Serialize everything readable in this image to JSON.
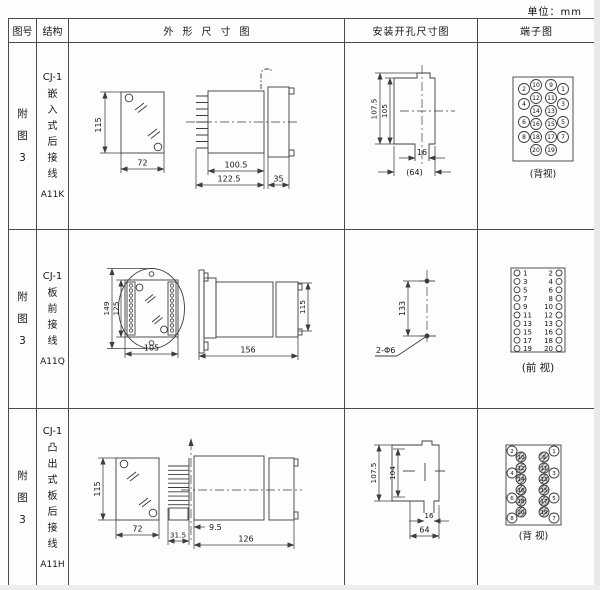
{
  "unit_label": "单位：mm",
  "headers": {
    "fig": "图号",
    "structure": "结构",
    "outline": "外形尺寸图",
    "mounting": "安装开孔尺寸图",
    "terminal": "端子图"
  },
  "rows": [
    {
      "fig": "附\n图\n3",
      "model": "CJ-1",
      "structure": "嵌\n入\n式\n后\n接\n线",
      "code": "A11K",
      "outline": {
        "front_h": "115",
        "front_w": "72",
        "body_len": "100.5",
        "total_len": "122.5",
        "rear_len": "35"
      },
      "mounting": {
        "total_h": "107.5",
        "cutout_h": "105",
        "slot_w": "16",
        "cutout_w": "(64)"
      },
      "terminal": {
        "view": "(背视)",
        "inner_left": [
          "10",
          "12",
          "14",
          "16",
          "18",
          "20"
        ],
        "inner_right": [
          "9",
          "11",
          "13",
          "15",
          "17",
          "19"
        ],
        "outer_left": [
          "2",
          "4",
          "6",
          "8"
        ],
        "outer_right": [
          "1",
          "3",
          "5",
          "7"
        ]
      }
    },
    {
      "fig": "附\n图\n3",
      "model": "CJ-1",
      "structure": "板\n前\n接\n线",
      "code": "A11Q",
      "outline": {
        "flange_h": "149",
        "inner_h": "125",
        "front_w": "105",
        "total_len": "156",
        "rear_h": "115"
      },
      "mounting": {
        "hole_pitch": "133",
        "hole_label": "2-Φ6"
      },
      "terminal": {
        "view": "(前 视)",
        "left": [
          "1",
          "3",
          "5",
          "7",
          "9",
          "11",
          "13",
          "15",
          "17",
          "19"
        ],
        "right": [
          "2",
          "4",
          "6",
          "8",
          "10",
          "12",
          "13",
          "16",
          "18",
          "20"
        ]
      }
    },
    {
      "fig": "附\n图\n3",
      "model": "CJ-1",
      "structure": "凸\n出\n式\n板\n后\n接\n线",
      "code": "A11H",
      "outline": {
        "front_h": "115",
        "front_w": "72",
        "pin_len": "31.5",
        "offset": "9.5",
        "body_len": "126"
      },
      "mounting": {
        "total_h": "107.5",
        "cutout_h": "104",
        "slot_w": "16",
        "cutout_w": "64"
      },
      "terminal": {
        "view": "(背 视)",
        "inner_left": [
          "10",
          "12",
          "14",
          "16",
          "18",
          "20"
        ],
        "inner_right": [
          "9",
          "11",
          "13",
          "15",
          "17",
          "19"
        ],
        "outer_left": [
          "2",
          "4",
          "6",
          "8"
        ],
        "outer_right": [
          "1",
          "3",
          "5",
          "7"
        ]
      }
    }
  ]
}
